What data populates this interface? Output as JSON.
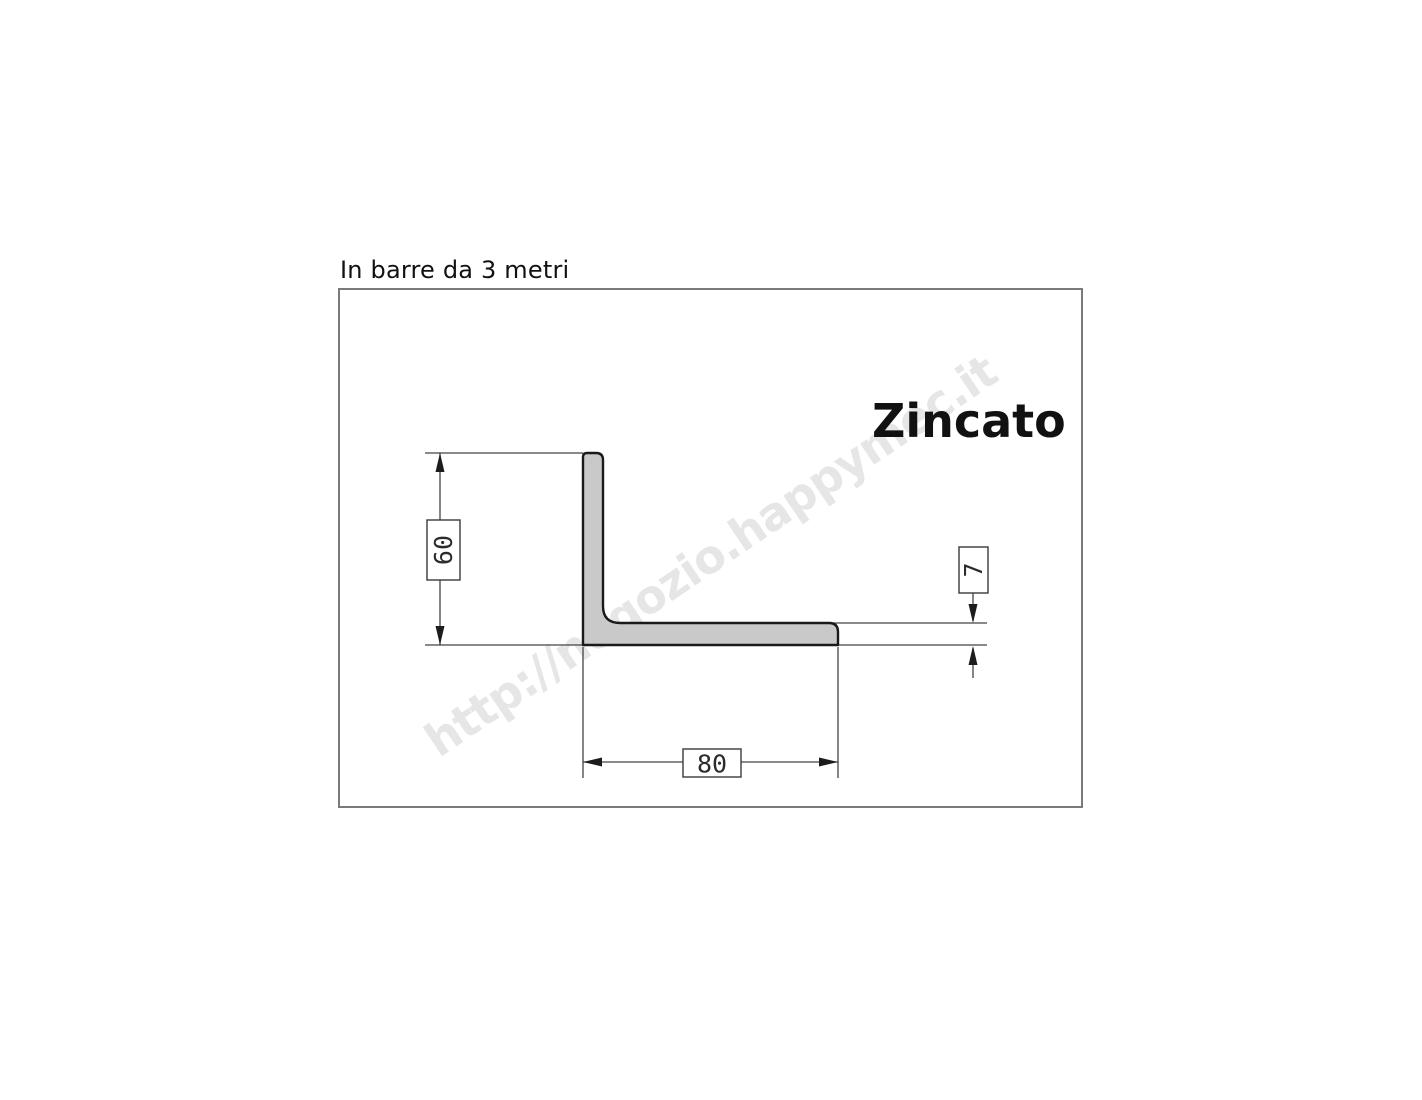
{
  "heading": {
    "text": "In barre da 3 metri"
  },
  "drawing": {
    "finish_label": "Zincato",
    "watermark_url": "http://negozio.happymec.it",
    "dimensions": {
      "height_mm": "60",
      "thickness_mm": "7",
      "width_mm": "80"
    },
    "colors": {
      "profile_fill": "#c9c9c9",
      "profile_outline": "#1a1a1a",
      "dimension_lines": "#444444",
      "frame_border": "#7a7a7a",
      "watermark": "#e6e6e6"
    }
  }
}
